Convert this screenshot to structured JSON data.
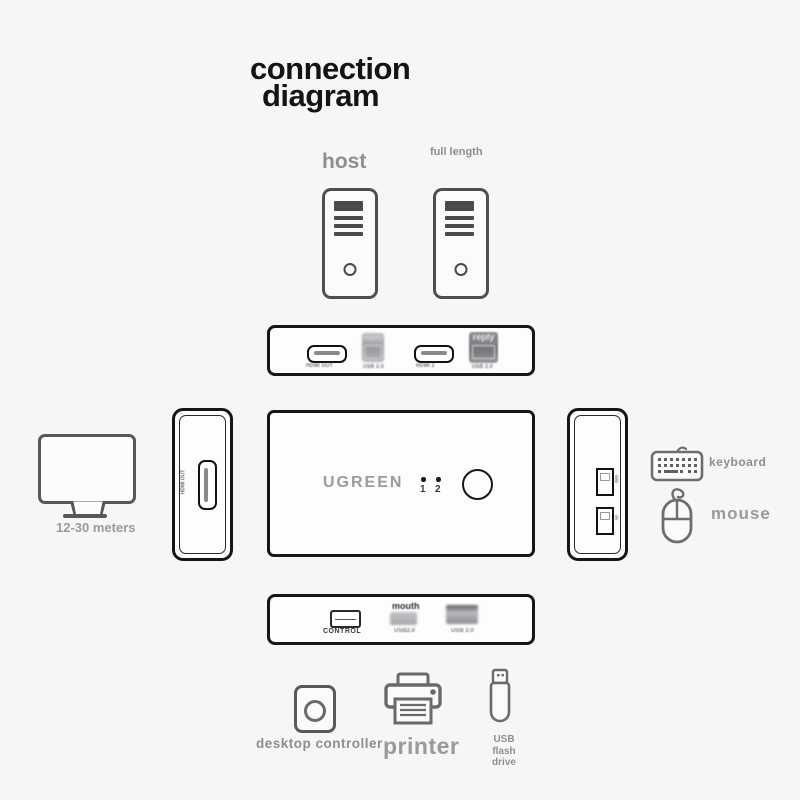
{
  "title": {
    "line1": "connection",
    "line2": "diagram"
  },
  "labels": {
    "host": "host",
    "full_length": "full length",
    "monitor": "12-30 meters",
    "keyboard": "keyboard",
    "mouse": "mouse",
    "desktop_controller": "desktop controller",
    "printer": "printer",
    "usb_flash_line1": "USB flash",
    "usb_flash_line2": "drive"
  },
  "top_panel": {
    "hdmi1_label": "HDMI OUT",
    "usb_b1_caption": "reply",
    "usb_b1_sub": "USB 2.0",
    "hdmi2_label": "HDMI 2",
    "usb_b2_caption": "reply",
    "usb_b2_sub": "USB 2.0"
  },
  "device": {
    "brand": "UGREEN",
    "led_labels": [
      "1",
      "2"
    ]
  },
  "side_panels": {
    "hdmi_out_vertical": "HDMI OUT"
  },
  "bottom_panel": {
    "control_label": "CONTROL",
    "usb1_caption": "mouth",
    "usb1_label": "USB2.0",
    "usb2_label": "USB 2.0"
  },
  "colors": {
    "background": "#f6f6f8",
    "panel_stroke": "#161616",
    "icon_stroke": "#5f5f5f",
    "label_gray": "#8e8e8e"
  }
}
